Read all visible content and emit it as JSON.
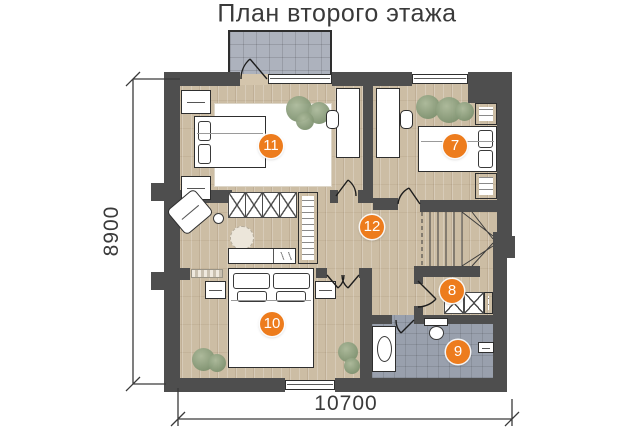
{
  "title": "План второго этажа",
  "dimensions": {
    "height_label": "8900",
    "width_label": "10700"
  },
  "rooms": [
    {
      "number": "7"
    },
    {
      "number": "8"
    },
    {
      "number": "9"
    },
    {
      "number": "10"
    },
    {
      "number": "11"
    },
    {
      "number": "12"
    }
  ],
  "colors": {
    "accent_orange": "#ed7c1d",
    "wall_gray": "#4e4e4e",
    "wood_floor": "#ccbda4",
    "balcony_tile": "#adb2bd",
    "bathroom_tile": "#99a0ad",
    "dimension_text": "#3a3a3a"
  }
}
